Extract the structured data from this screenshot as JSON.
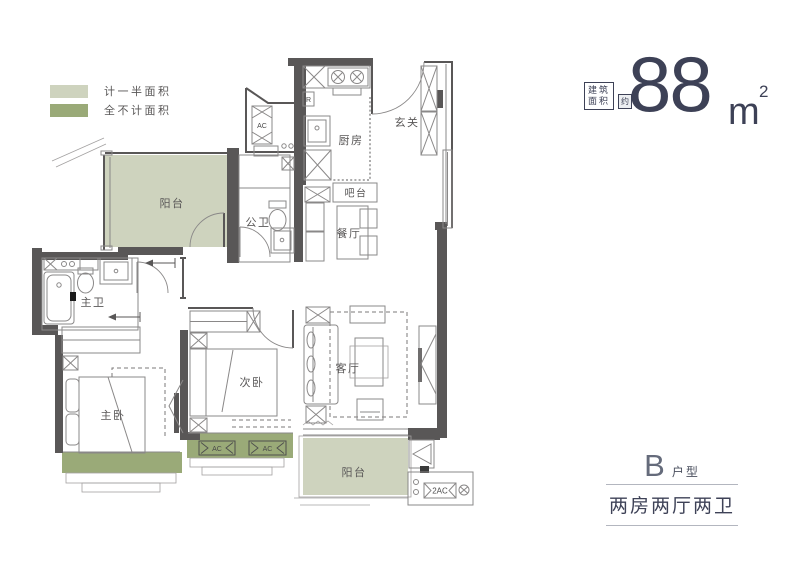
{
  "legend": {
    "items": [
      {
        "label": "计一半面积",
        "color": "#ced3be"
      },
      {
        "label": "全不计面积",
        "color": "#9aaa78"
      }
    ]
  },
  "area_badge": {
    "label_line1": "建筑",
    "label_line2": "面积",
    "approx": "约",
    "value": "88",
    "unit": "m",
    "unit_sup": "2"
  },
  "unit_info": {
    "type_letter": "B",
    "type_label": "户型",
    "layout": "两房两厅两卫"
  },
  "floorplan": {
    "rooms": {
      "balcony_top": "阳台",
      "guest_bath": "公卫",
      "kitchen": "厨房",
      "entry": "玄关",
      "bar": "吧台",
      "dining": "餐厅",
      "master_bath": "主卫",
      "master_bedroom": "主卧",
      "second_bedroom": "次卧",
      "living": "客厅",
      "balcony_bottom": "阳台"
    },
    "equipment": {
      "ac_niche": "AC",
      "ac_left": "AC",
      "ac_right": "AC",
      "ac_double": "2AC",
      "fridge": "R"
    },
    "colors": {
      "wall": "#595757",
      "half_area": "#ced3be",
      "excluded_area": "#9aaa78",
      "furniture_line": "#8a8888"
    }
  }
}
